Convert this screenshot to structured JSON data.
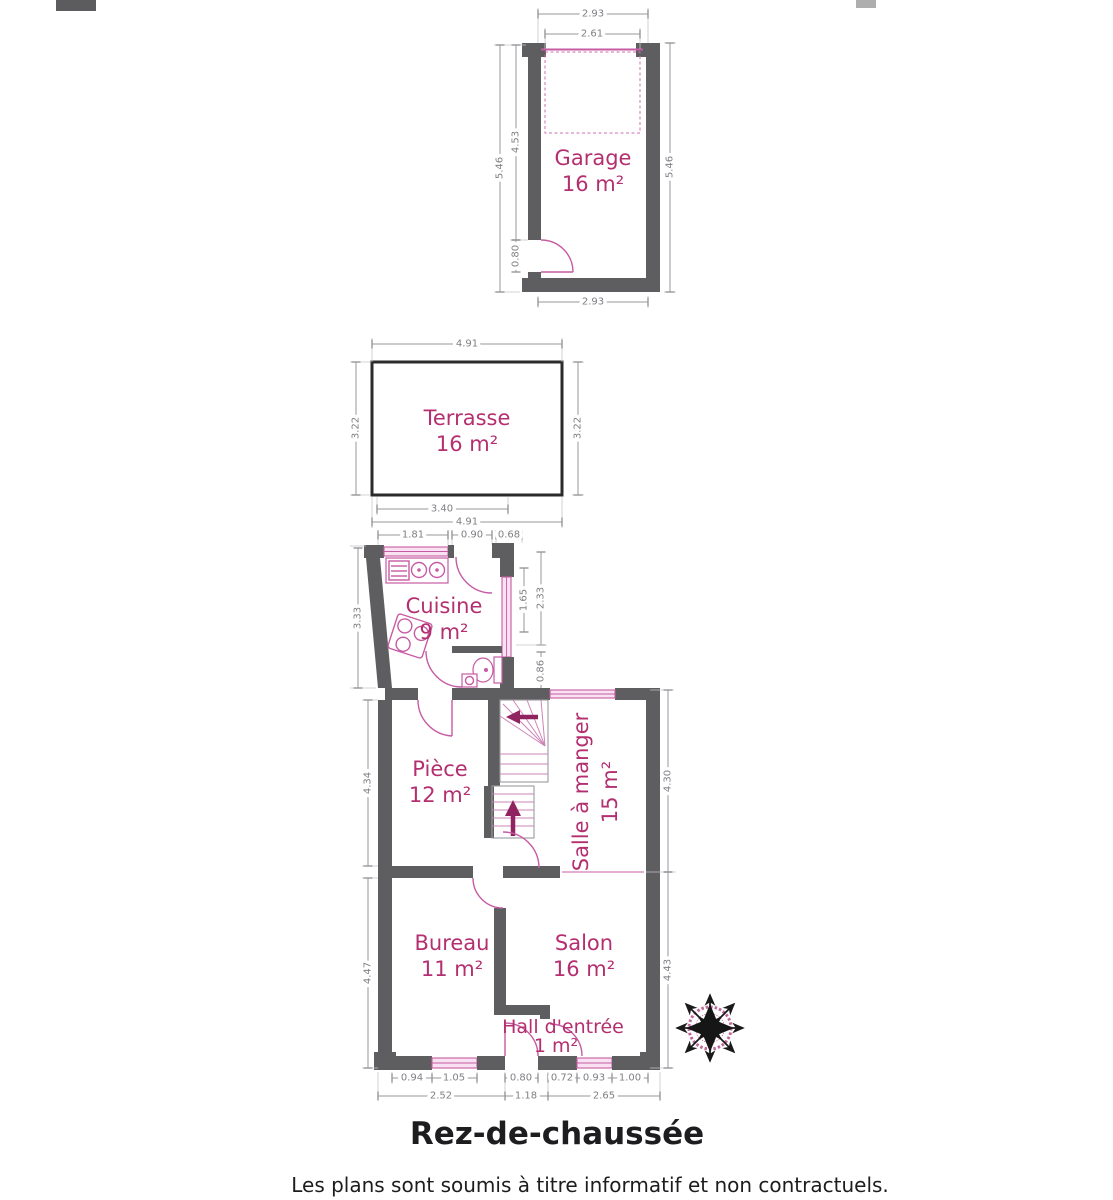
{
  "meta": {
    "title": "Rez-de-chaussée",
    "disclaimer": "Les plans sont soumis à titre informatif et non contractuels."
  },
  "colors": {
    "wall": "#5e5e61",
    "room_label": "#b42f70",
    "fixture_pink": "#c75ba3",
    "window_fill": "#f8e2f1",
    "dimension_gray": "#7f7f84",
    "stair_arrow": "#8f2460",
    "terrace_border": "#2b2b2b",
    "compass_ring": "#c0679b",
    "title_text": "#1d1d1f"
  },
  "rooms": {
    "garage": {
      "name": "Garage",
      "area": "16 m²"
    },
    "terrasse": {
      "name": "Terrasse",
      "area": "16 m²"
    },
    "cuisine": {
      "name": "Cuisine",
      "area": "9 m²"
    },
    "piece": {
      "name": "Pièce",
      "area": "12 m²"
    },
    "salle_a_manger": {
      "name": "Salle à manger",
      "area": "15 m²"
    },
    "bureau": {
      "name": "Bureau",
      "area": "11 m²"
    },
    "salon": {
      "name": "Salon",
      "area": "16 m²"
    },
    "hall": {
      "name": "Hall d'entrée",
      "area": "1 m²"
    }
  },
  "dims": {
    "garage_top": "2.93",
    "garage_top_inner": "2.61",
    "garage_left": "5.46",
    "garage_left_inner": "4.53",
    "garage_door": "0.80",
    "garage_right": "5.46",
    "garage_bottom": "2.93",
    "terrasse_top": "4.91",
    "terrasse_left": "3.22",
    "terrasse_right": "3.22",
    "terrasse_bottom_inner": "3.40",
    "terrasse_bottom": "4.91",
    "cuisine_top_1": "1.81",
    "cuisine_top_2": "0.90",
    "cuisine_top_3": "0.68",
    "cuisine_left": "3.33",
    "cuisine_window": "1.65",
    "cuisine_right": "2.33",
    "wc_right": "0.86",
    "piece_left": "4.34",
    "bureau_left": "4.47",
    "salle_right": "4.30",
    "salon_right": "4.43",
    "bottom_1": "0.94",
    "bottom_2": "1.05",
    "bottom_3": "0.80",
    "bottom_4": "0.72",
    "bottom_5": "0.93",
    "bottom_6": "1.00",
    "bottom_total_1": "2.52",
    "bottom_total_2": "1.18",
    "bottom_total_3": "2.65"
  }
}
